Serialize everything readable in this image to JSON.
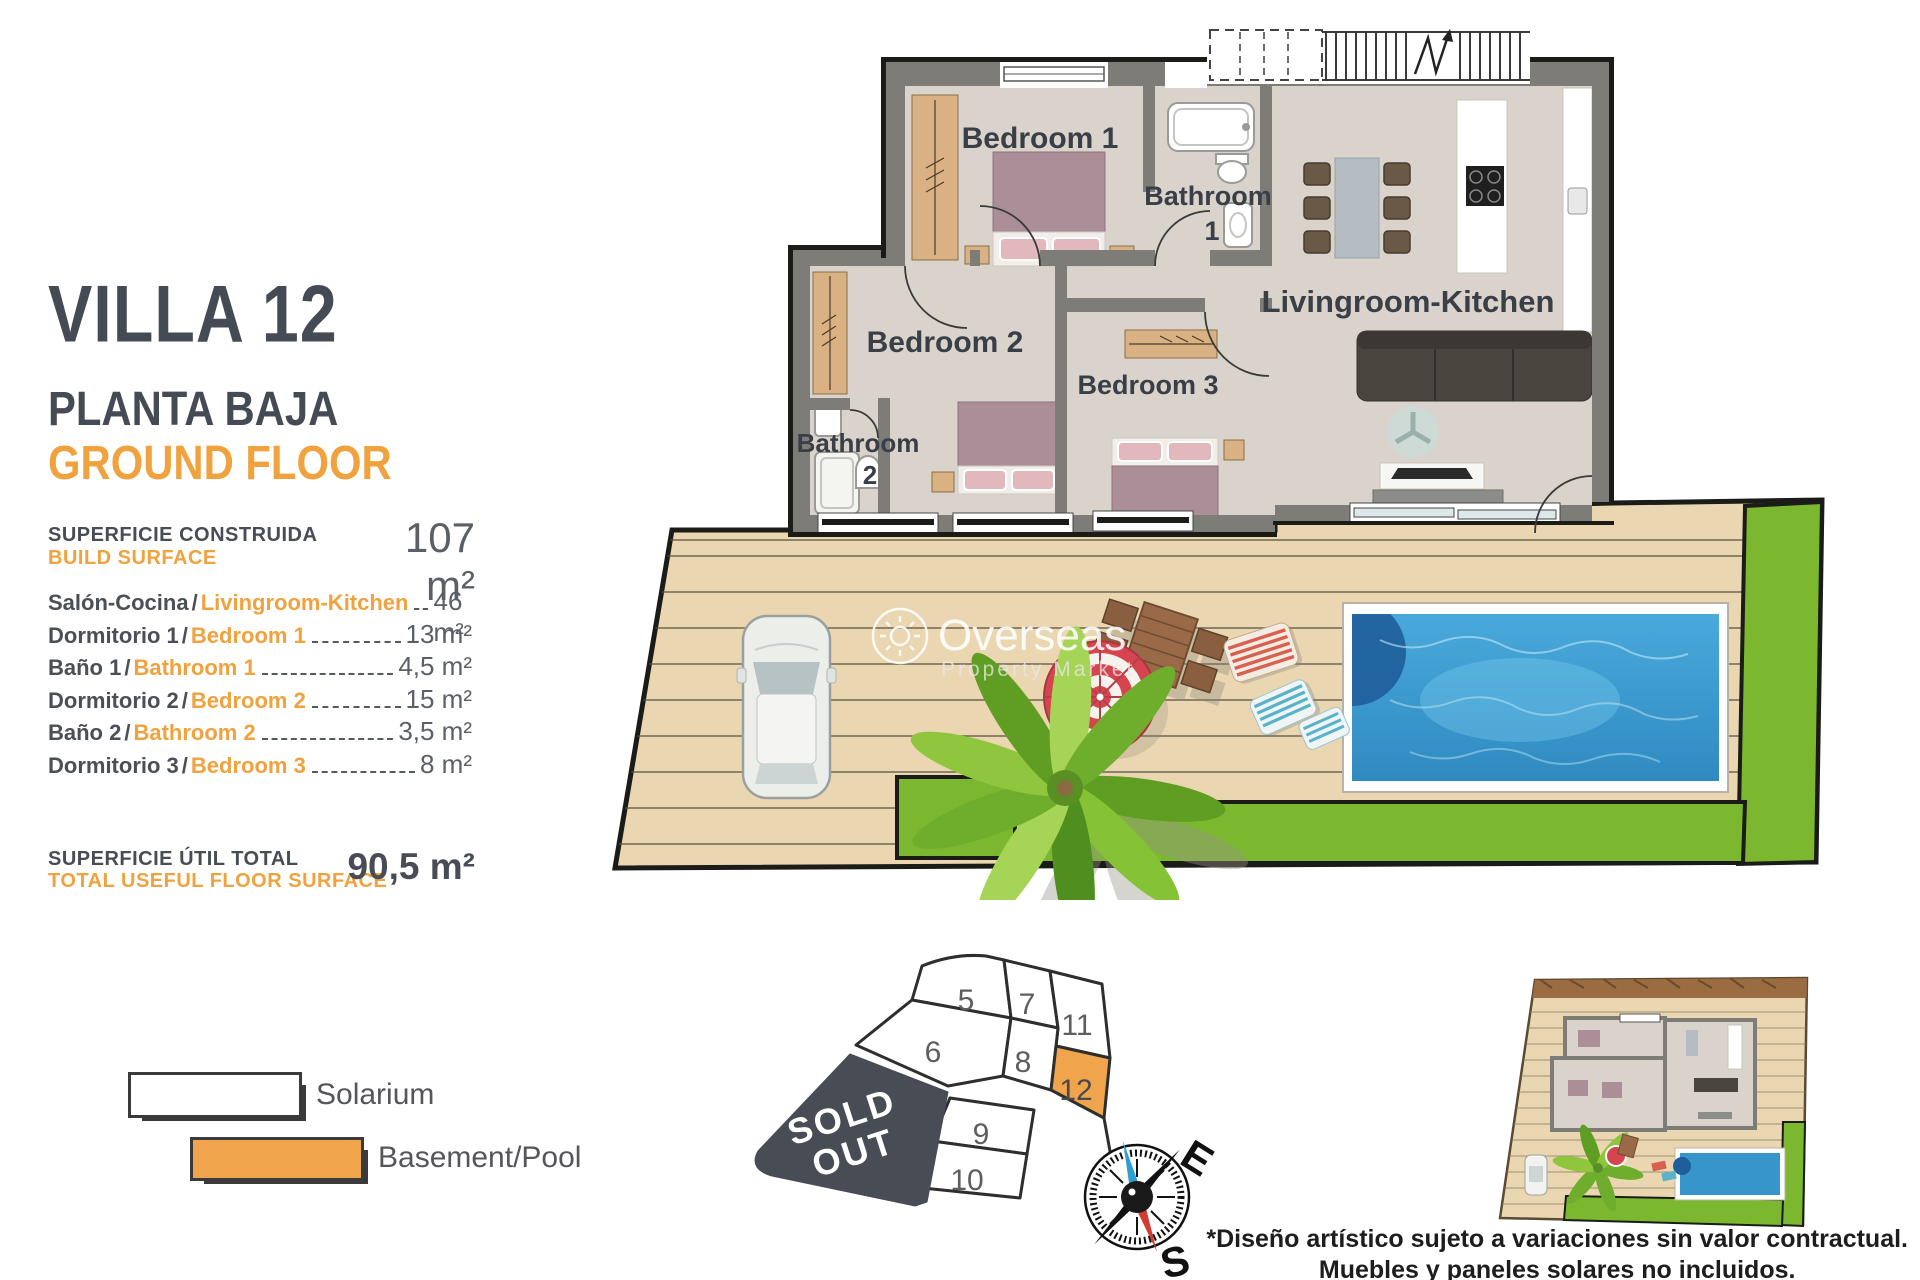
{
  "panel": {
    "title": "VILLA 12",
    "subtitle_es": "PLANTA BAJA",
    "subtitle_en": "GROUND FLOOR",
    "build_surface_label_es": "SUPERFICIE CONSTRUIDA",
    "build_surface_label_en": "BUILD SURFACE",
    "build_surface_value": "107 m²",
    "rooms": [
      {
        "es": "Salón-Cocina",
        "en": "Livingroom-Kitchen",
        "value": "46 m²"
      },
      {
        "es": "Dormitorio 1",
        "en": "Bedroom 1",
        "value": "13 m²"
      },
      {
        "es": "Baño 1",
        "en": "Bathroom 1",
        "value": "4,5 m²"
      },
      {
        "es": "Dormitorio 2",
        "en": "Bedroom 2",
        "value": "15 m²"
      },
      {
        "es": "Baño 2",
        "en": "Bathroom 2",
        "value": "3,5 m²"
      },
      {
        "es": "Dormitorio 3",
        "en": "Bedroom 3",
        "value": "8 m²"
      }
    ],
    "total_label_es": "SUPERFICIE ÚTIL TOTAL",
    "total_label_en": "TOTAL USEFUL FLOOR SURFACE",
    "total_value": "90,5 m²"
  },
  "legend": {
    "solarium": "Solarium",
    "basement_pool": "Basement/Pool"
  },
  "floorplan": {
    "bedroom1": "Bedroom 1",
    "bathroom1_line1": "Bathroom",
    "bathroom1_line2": "1",
    "bedroom2": "Bedroom 2",
    "bedroom3": "Bedroom 3",
    "bathroom2_line1": "Bathroom",
    "bathroom2_line2": "2",
    "living": "Livingroom-Kitchen"
  },
  "watermark": {
    "line1": "Overseas",
    "line2": "Property Market"
  },
  "plot_map": {
    "sold_out_line1": "SOLD",
    "sold_out_line2": "OUT",
    "plots": [
      "5",
      "6",
      "7",
      "8",
      "9",
      "10",
      "11",
      "12"
    ],
    "highlighted_plot": "12"
  },
  "compass": {
    "east": "E",
    "south": "S"
  },
  "footer": {
    "line1": "*Diseño artístico sujeto a variaciones sin valor contractual.",
    "line2": "Muebles y paneles solares no incluidos."
  },
  "colors": {
    "accent_orange": "#f0a23e",
    "title_dark": "#474c55",
    "wall_gray": "#7e7c77",
    "floor": "#d9d3cb",
    "deck": "#ead7b2",
    "lawn": "#7cb82f",
    "pool_water": "#3e9ed2",
    "sold_out_bg": "#474c55"
  }
}
